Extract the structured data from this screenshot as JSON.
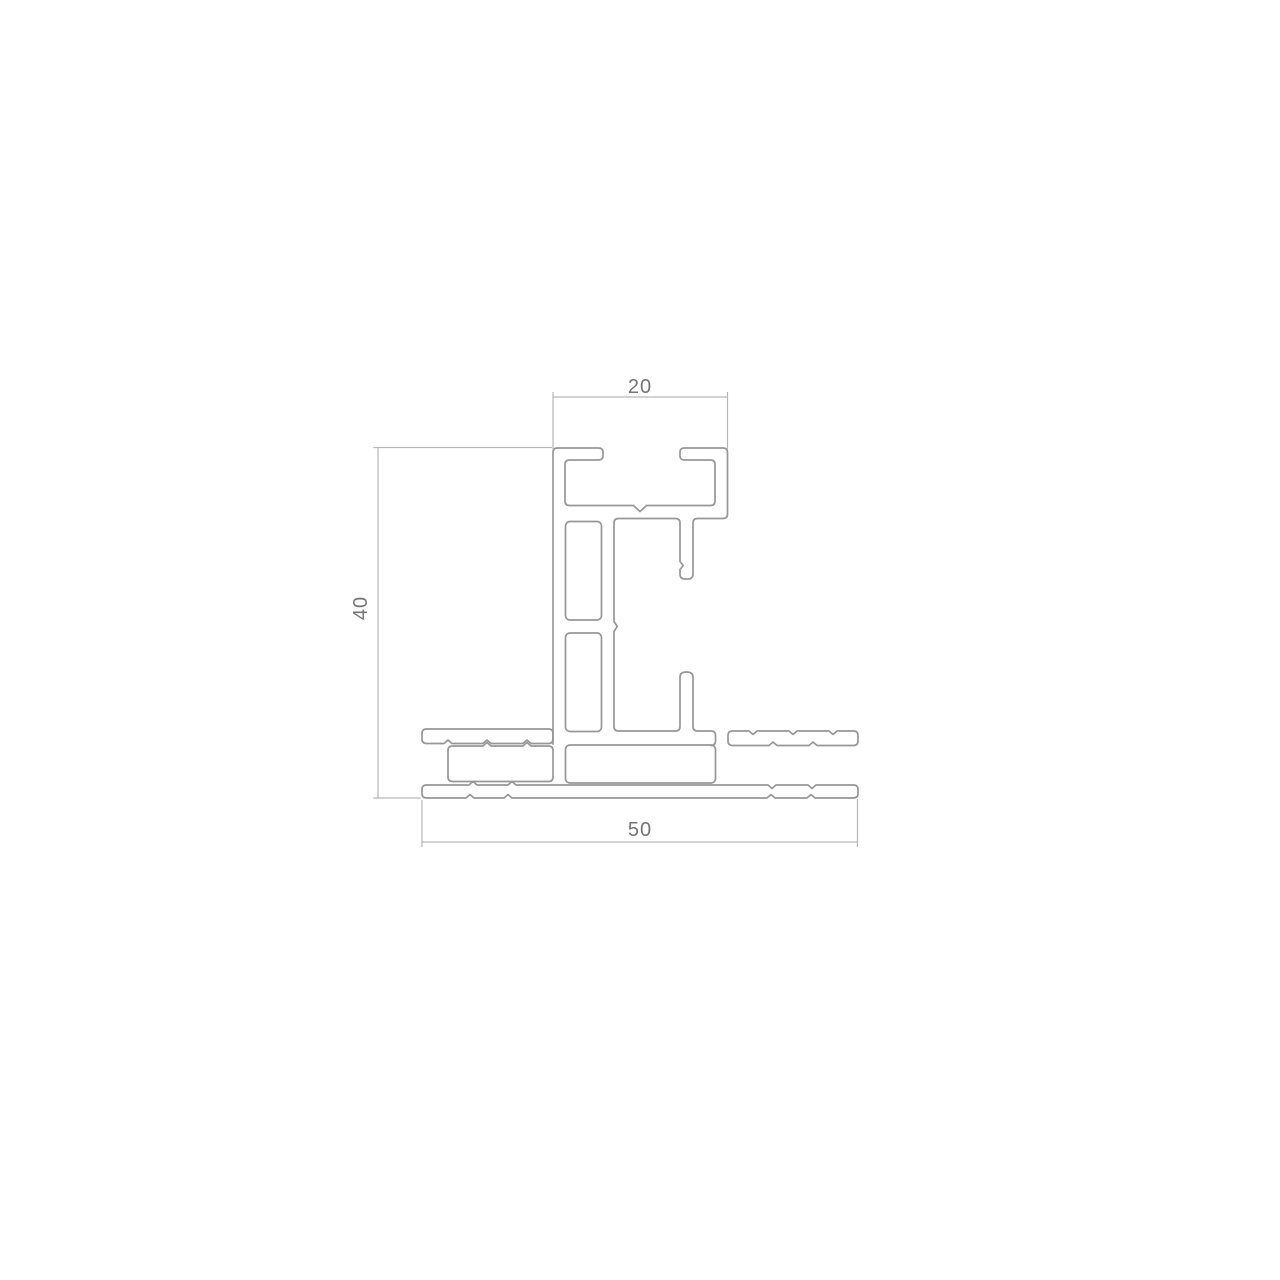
{
  "drawing": {
    "labels": {
      "width_top": "20",
      "height_left": "40",
      "width_bottom": "50"
    },
    "colors": {
      "background": "#ffffff",
      "profile_stroke": "#979797",
      "dimension_stroke": "#b6b6b6",
      "label_text": "#747474"
    }
  }
}
